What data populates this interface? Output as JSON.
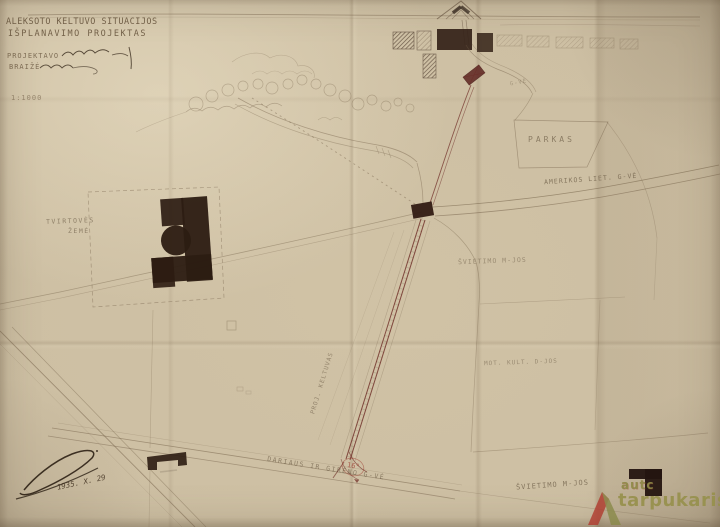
{
  "title_block": {
    "line1": "ALEKSOTO KELTUVO SITUACIJOS",
    "line2": "IŠPLANAVIMO PROJEKTAS",
    "projektavo_label": "PROJEKTAVO",
    "braize_label": "BRAIŽĖ",
    "scale": "1:1000"
  },
  "annotations": {
    "date": "1935. X. 29",
    "angle": "16°"
  },
  "map_labels": {
    "tvirtoves_line1": "TVIRTOVĖS",
    "tvirtoves_line2": "ŽEMĖ",
    "parkas": "PARKAS",
    "amerikos_street": "AMERIKOS LIET. G-VĖ",
    "svietimo_upper": "ŠVIETIMO M-JOS",
    "mot_kult": "MOT. KULT. D-JOS",
    "svietimo_lower": "ŠVIETIMO M-JOS",
    "dariaus_street": "DARIAUS IR GIRĖNO G-VĖ",
    "keltuvas": "PROJ. KELTUVAS",
    "small_street": "G-VĖ"
  },
  "watermark": {
    "line1": "autc",
    "line2": "tarpukaris"
  },
  "colors": {
    "paper": "#cdbfa3",
    "ink": "#6f5c44",
    "building": "#2c1c12",
    "funicular_red": "#6d2a24",
    "annotation_red": "#9c3a2e",
    "watermark_red": "#b13c30",
    "watermark_olive": "#8e8947"
  }
}
